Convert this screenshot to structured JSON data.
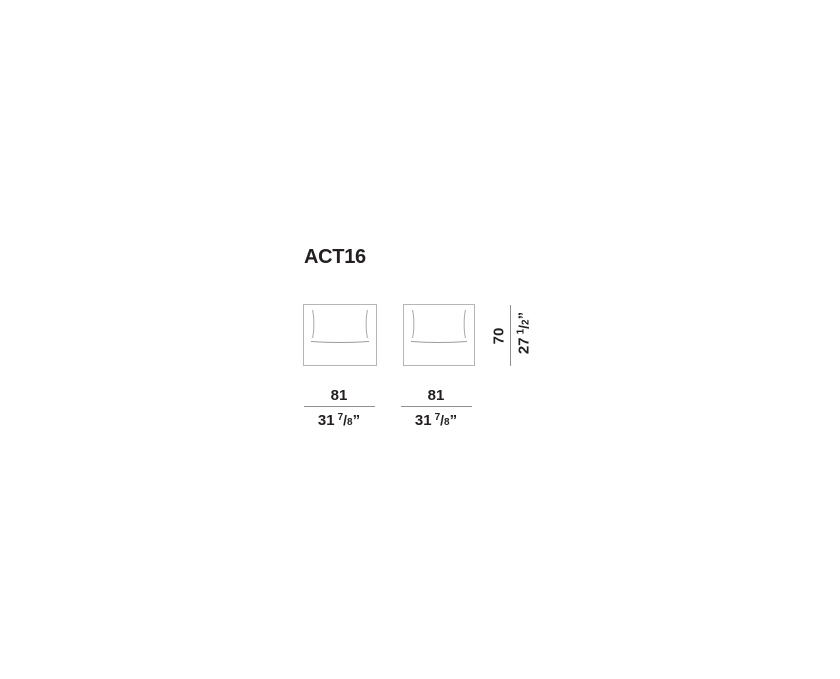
{
  "title": "ACT16",
  "colors": {
    "background": "#ffffff",
    "text": "#231f20",
    "module_outline": "#b5b5b5",
    "cushion_line": "#a9a9a9",
    "dimension_line": "#8f8f8f"
  },
  "modules": [
    {
      "id": "module-1"
    },
    {
      "id": "module-2"
    }
  ],
  "width_dim": {
    "cm": "81",
    "inch_whole": "31",
    "frac_num": "7",
    "frac_slash": "/",
    "frac_den": "8",
    "unit_mark": "”"
  },
  "height_dim": {
    "cm": "70",
    "inch_whole": "27",
    "frac_num": "1",
    "frac_slash": "/",
    "frac_den": "2",
    "unit_mark": "”"
  }
}
